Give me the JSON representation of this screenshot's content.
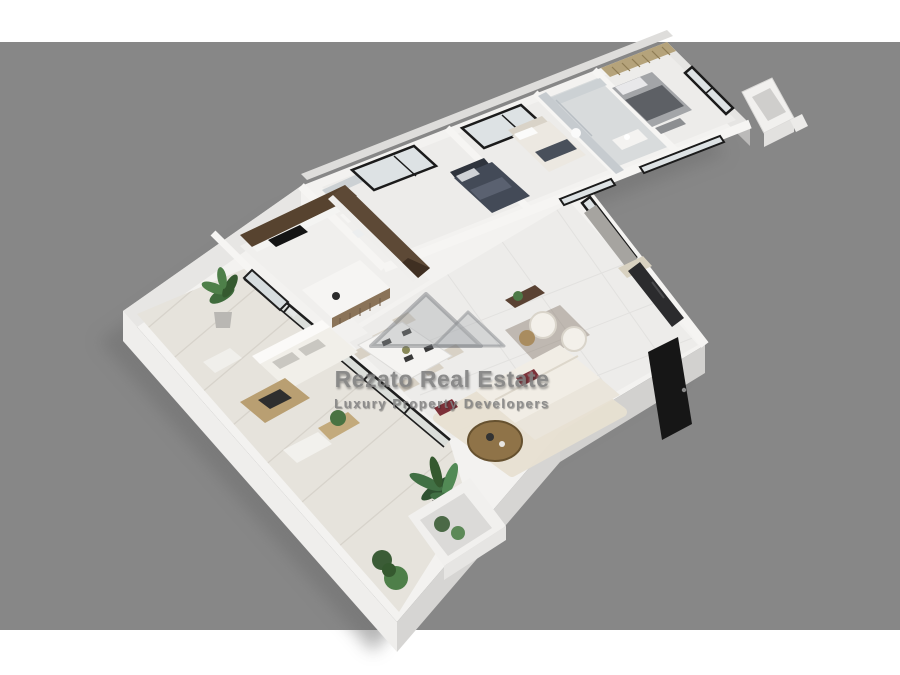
{
  "watermark": {
    "logo": "mountain-peaks-logo",
    "line1": "Rezato Real Estate",
    "line2": "Luxury Property Developers"
  },
  "scene": {
    "type": "3d-isometric-floor-plan-render",
    "rooms": [
      "kids-bedroom",
      "bedroom",
      "bathroom",
      "master-bedroom",
      "ensuite-bathroom",
      "kitchen",
      "dining-area",
      "living-room",
      "entry",
      "terrace",
      "balcony",
      "planter-box"
    ],
    "furniture": [
      "dark-double-bed",
      "light-double-bed",
      "gray-master-bed",
      "wood-slat-headboard",
      "u-shaped-kitchen-cabinets",
      "kitchen-island",
      "dining-table-with-six-chairs",
      "l-shaped-white-sofa",
      "round-wood-coffee-table",
      "boucle-armchairs",
      "tv-media-wall",
      "black-entry-door",
      "outdoor-sofa",
      "outdoor-coffee-table",
      "potted-plants"
    ]
  },
  "colors": {
    "page_bg": "#ffffff",
    "backdrop": "#878787",
    "slab": "#f3f2f0",
    "floor": "#edecea",
    "floor_terrace": "#e6e3dc",
    "marble": "#ccd1d4",
    "wood_dark": "#57432f",
    "wood_mid": "#8a7358",
    "wood_light": "#b99f72",
    "sofa_white": "#f1ede5",
    "accent_red": "#7c3038",
    "bed_dark": "#434a57",
    "bed_gray": "#a3a5a8",
    "frame_black": "#1a1a1a",
    "glass": "#dde2e4",
    "plant_dark": "#3b5c36",
    "plant_mid": "#4e7f49",
    "watermark_gray": "#818181"
  }
}
